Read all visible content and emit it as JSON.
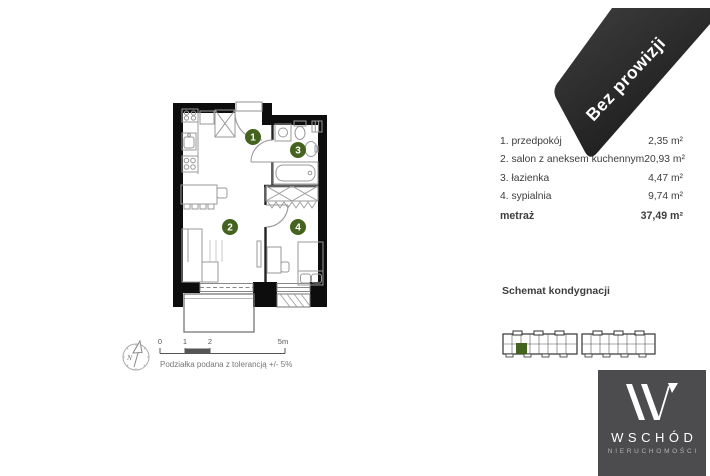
{
  "ribbon": {
    "label": "Bez prowizji"
  },
  "legend": {
    "rows": [
      {
        "label": "1. przedpokój",
        "value": "2,35 m²"
      },
      {
        "label": "2. salon z aneksem kuchennym",
        "value": "20,93 m²"
      },
      {
        "label": "3. łazienka",
        "value": "4,47 m²"
      },
      {
        "label": "4. sypialnia",
        "value": "9,74 m²"
      }
    ],
    "total": {
      "label": "metraż",
      "value": "37,49 m²"
    }
  },
  "plan": {
    "rooms": [
      "1",
      "2",
      "3",
      "4"
    ],
    "compass": "N",
    "scale_ticks": [
      "0",
      "1",
      "2",
      "5m"
    ],
    "scale_note": "Podziałka podana z tolerancją +/- 5%"
  },
  "schematic": {
    "title": "Schemat kondygnacji"
  },
  "logo": {
    "title": "WSCHÓD",
    "subtitle": "NIERUCHOMOŚCI"
  },
  "colors": {
    "accent_green": "#44631e",
    "ribbon_bg": "#2b2b2b",
    "logo_bg": "#4c4c4f",
    "wall_black": "#0d0d0d"
  }
}
